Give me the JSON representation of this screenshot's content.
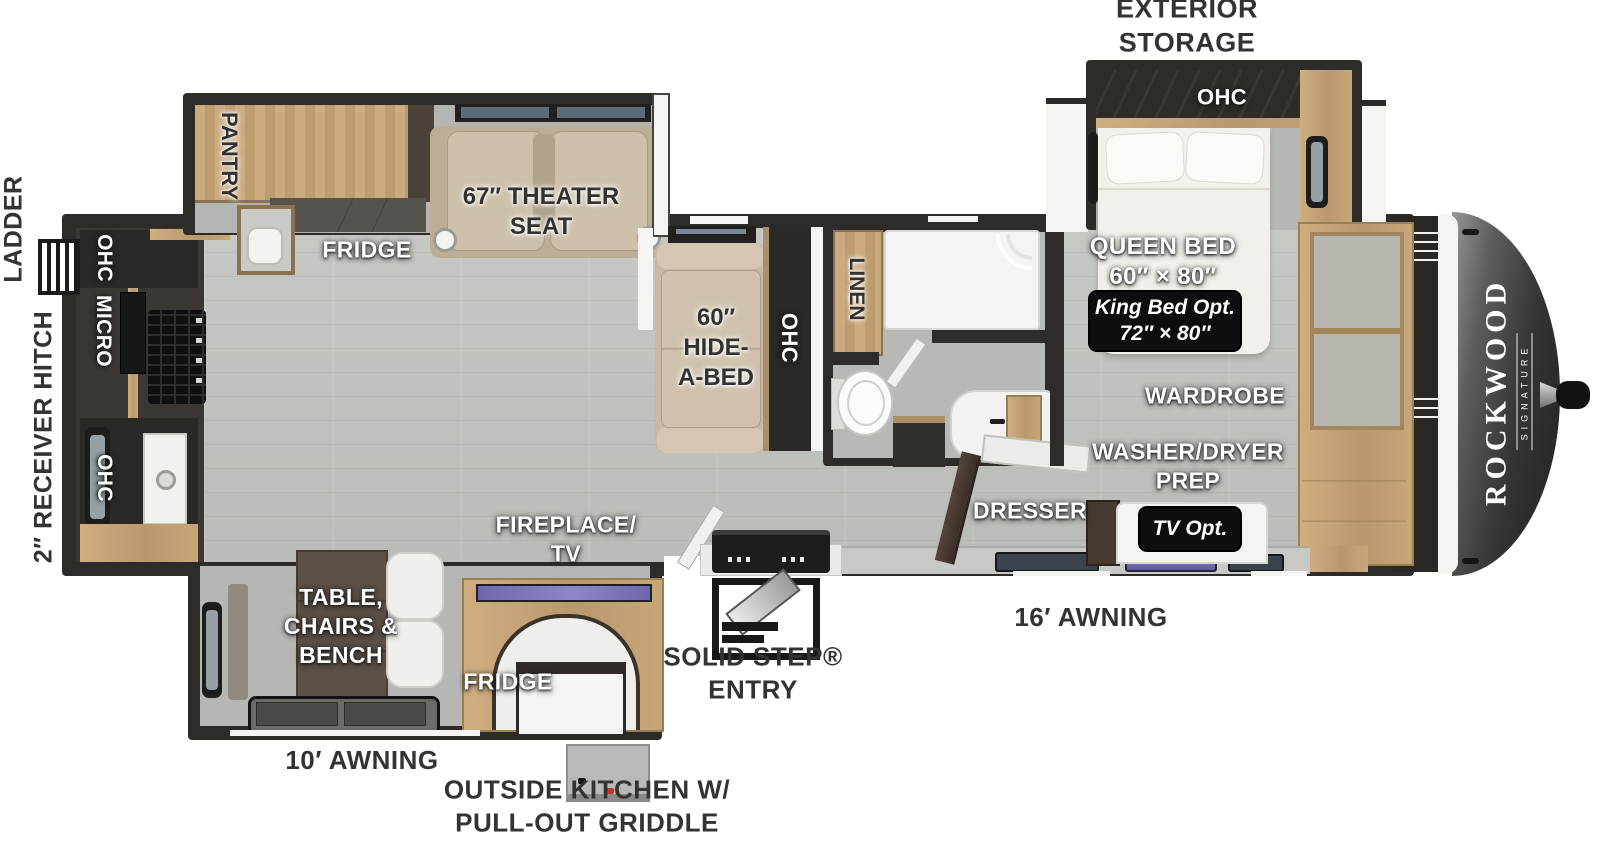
{
  "image_type": "rv-floor-plan",
  "brand": {
    "name": "ROCKWOOD",
    "series": "SIGNATURE"
  },
  "colors": {
    "wall": "#2e2c29",
    "floor": "#c1c3be",
    "wood": "#c5a678",
    "dark_cabinet": "#34302c",
    "sofa": "#c8b9a4",
    "front_cap": "#2f2f2f",
    "badge_bg": "#0e0e0e",
    "label_white": "#ffffff",
    "label_dark": "#343230",
    "exterior_text": "#333331",
    "tv_accent": "#7d76bd"
  },
  "labels": {
    "exterior_storage": "EXTERIOR\nSTORAGE",
    "ladder": "LADDER",
    "receiver_hitch": "2″ RECEIVER HITCH",
    "solid_step_entry": "SOLID STEP®\nENTRY",
    "awning_16": "16′ AWNING",
    "awning_10": "10′ AWNING",
    "outside_kitchen": "OUTSIDE KITCHEN W/\nPULL-OUT GRIDDLE",
    "bedroom_ohc": "OHC",
    "queen_bed": "QUEEN BED\n60″ × 80″",
    "king_bed_opt": "King Bed Opt.\n72″ × 80″",
    "wardrobe": "WARDROBE",
    "washer_dryer_prep": "WASHER/DRYER\nPREP",
    "dresser": "DRESSER",
    "tv_opt": "TV Opt.",
    "linen": "LINEN",
    "hide_a_bed": "60″\nHIDE-\nA-BED",
    "sofa_ohc": "OHC",
    "theater_seat": "67″ THEATER\nSEAT",
    "fridge_main": "FRIDGE",
    "pantry": "PANTRY",
    "kitchen_ohc_top": "OHC",
    "kitchen_micro": "MICRO",
    "kitchen_ohc_bottom": "OHC",
    "fireplace_tv": "FIREPLACE/\nTV",
    "dinette": "TABLE,\nCHAIRS &\nBENCH",
    "fridge_outside": "FRIDGE"
  }
}
